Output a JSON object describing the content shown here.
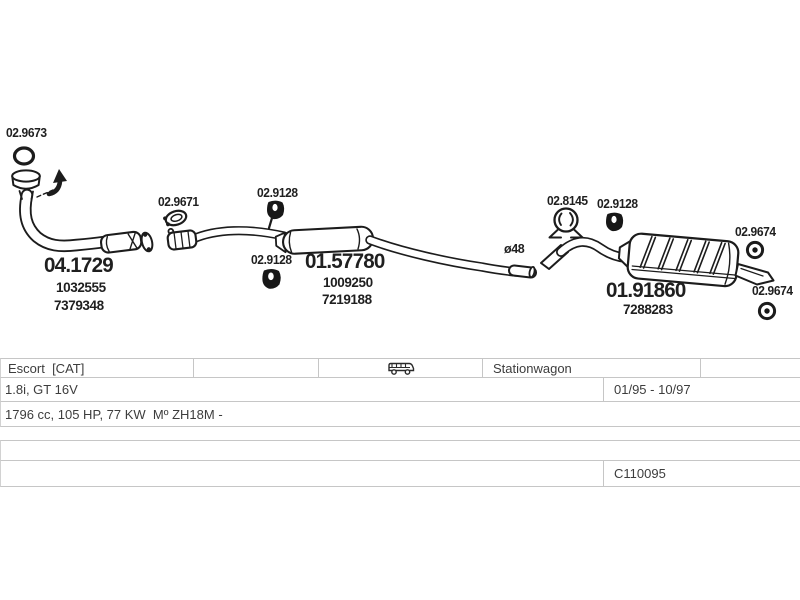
{
  "colors": {
    "ink": "#1c1c1c",
    "table_border": "#c6c6c6",
    "background": "#ffffff",
    "text": "#3d3d3d"
  },
  "diagram": {
    "gasket": {
      "id": "02.9673"
    },
    "front_pipe": {
      "id": "04.1729",
      "oe1": "1032555",
      "oe2": "7379348"
    },
    "clamp": {
      "id": "02.9671"
    },
    "hanger": {
      "id": "02.9128"
    },
    "centre_silencer": {
      "id": "01.57780",
      "oe1": "1009250",
      "oe2": "7219188"
    },
    "pipe_note": {
      "text": "ø48"
    },
    "bracket_mount": {
      "id": "02.8145"
    },
    "rear_silencer": {
      "id": "01.91860",
      "oe1": "7288283"
    },
    "rear_mount": {
      "id": "02.9674"
    }
  },
  "table": {
    "model": "Escort  [CAT]",
    "vehicle_icon": "van-icon",
    "body_type": "Stationwagon",
    "engine": "1.8i, GT 16V",
    "build_period": "01/95 - 10/97",
    "engine_spec": "1796 cc, 105 HP, 77 KW  Mº ZH18M -",
    "catalog_code": "C110095"
  }
}
